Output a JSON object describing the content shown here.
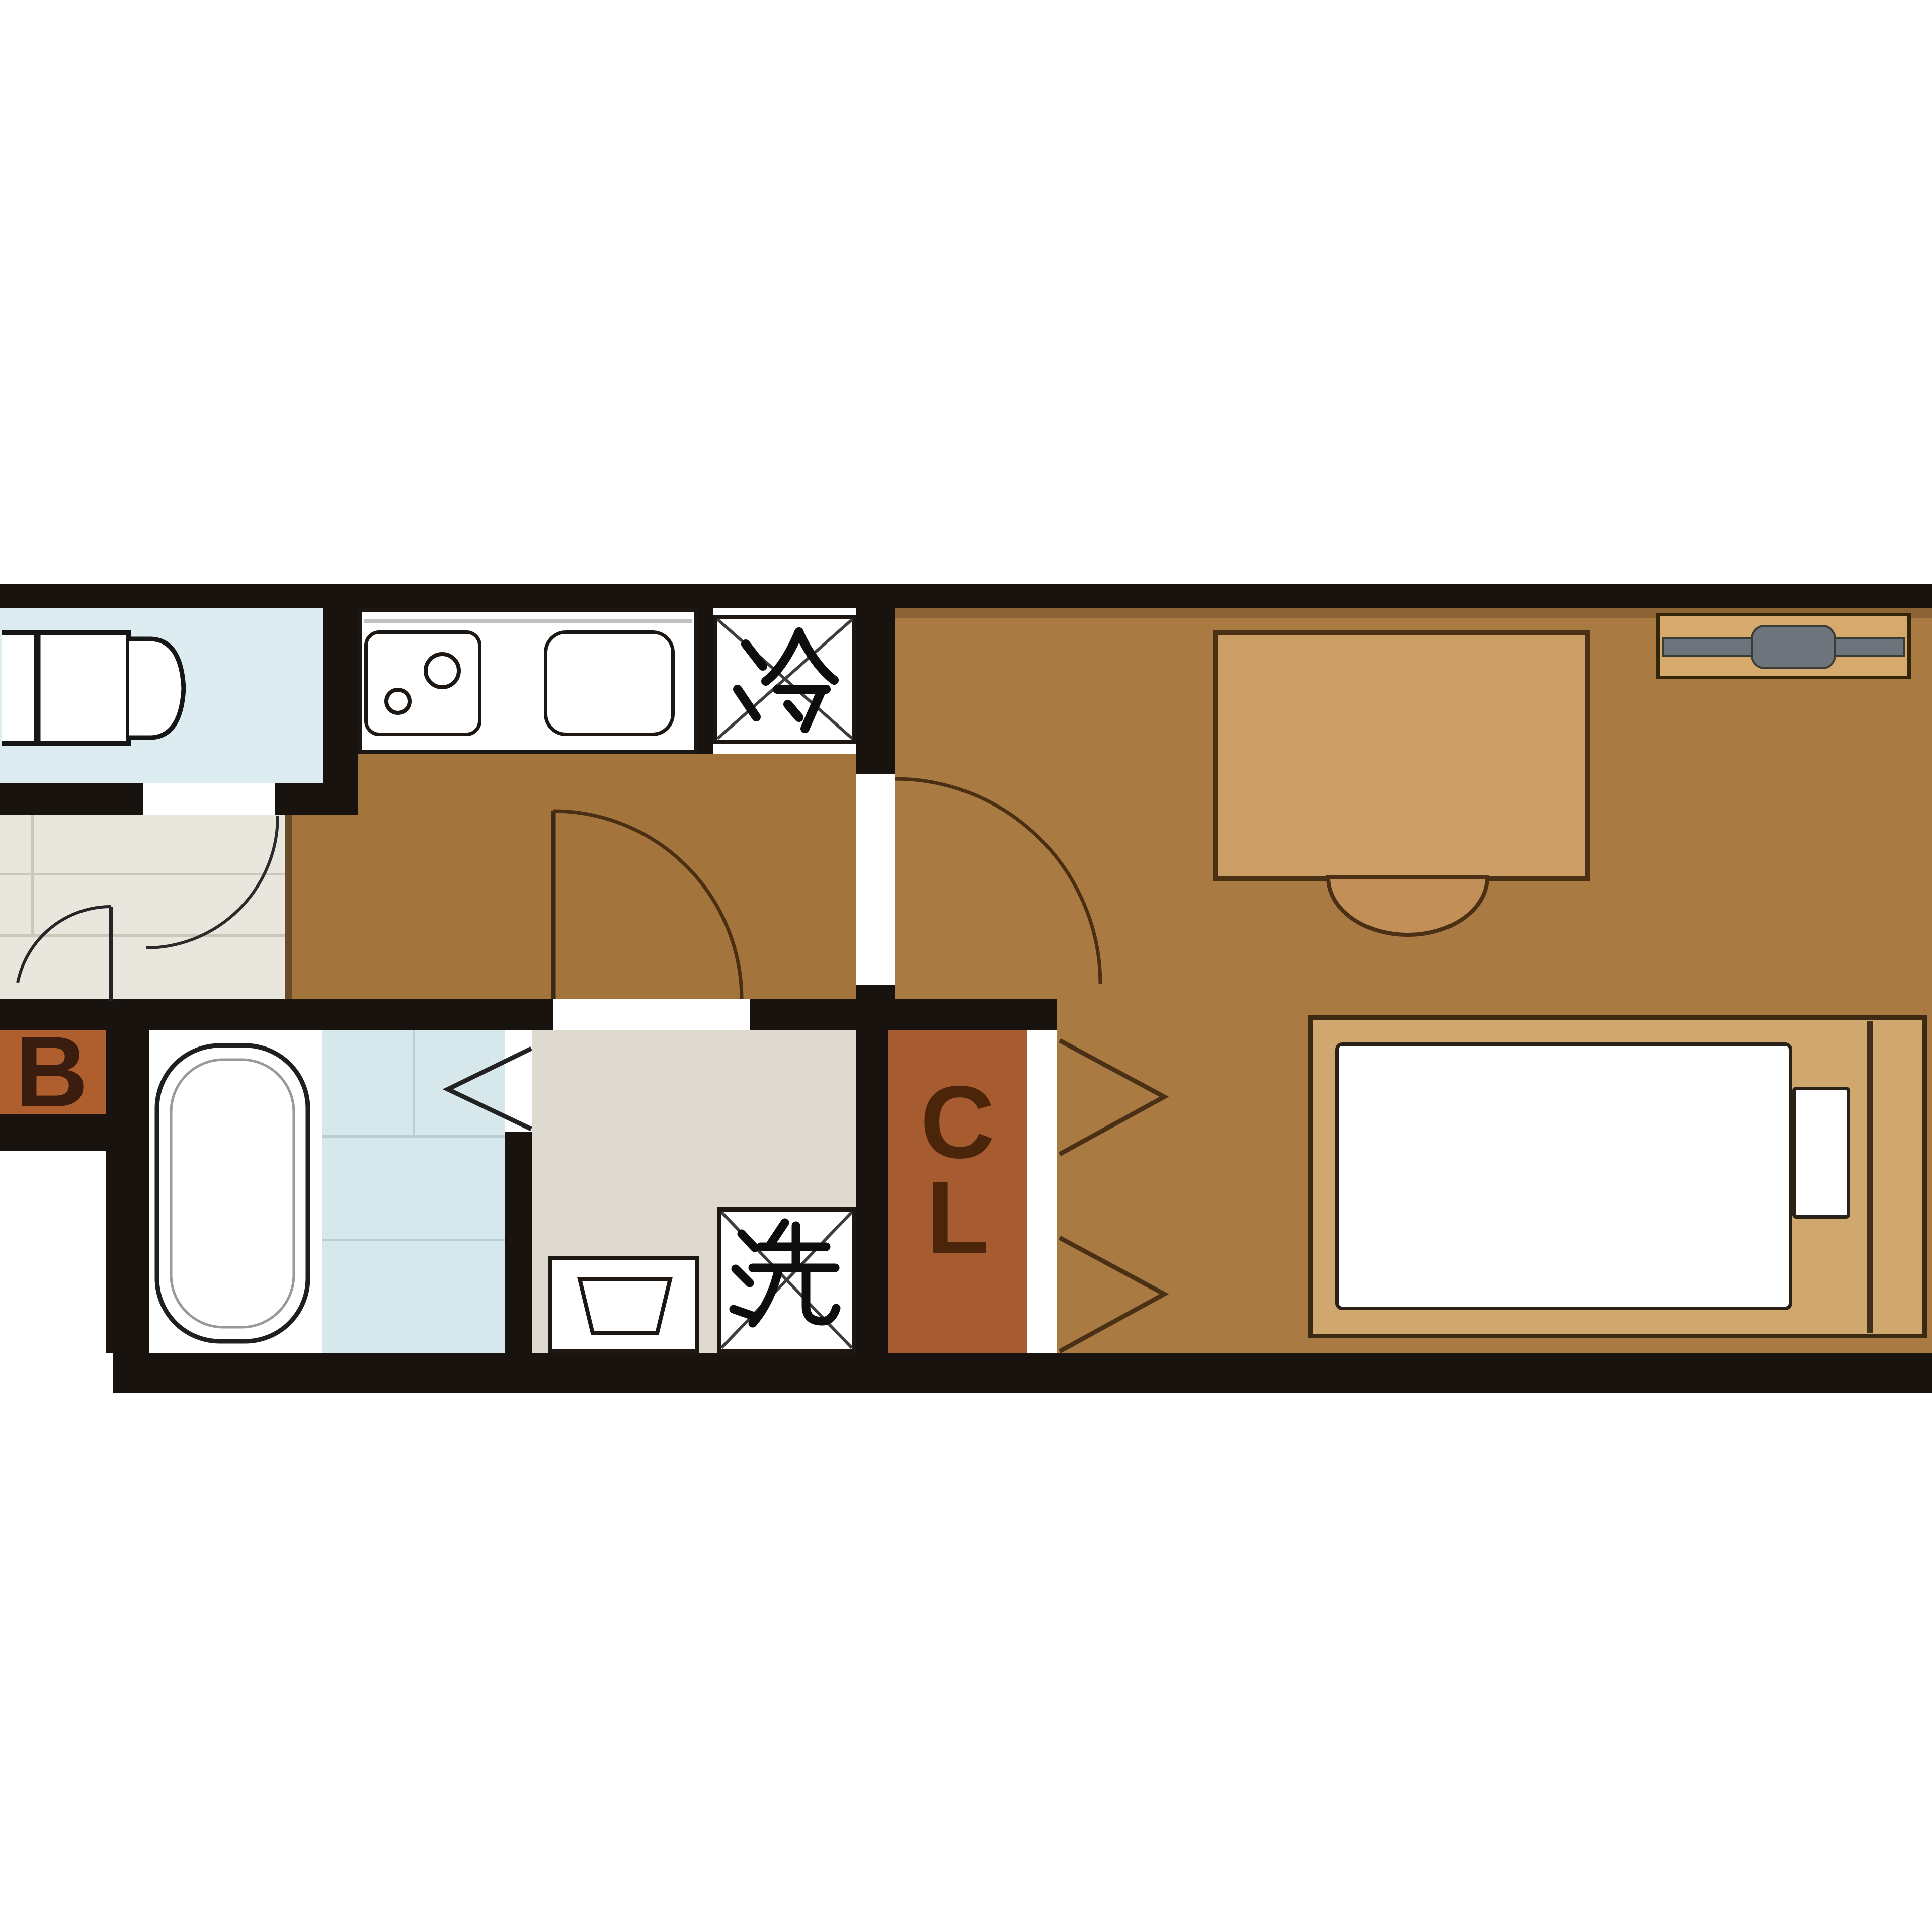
{
  "floor_plan": {
    "labels": {
      "balcony": "B",
      "closet_top": "C",
      "closet_bottom": "L",
      "refrigerator": "冷",
      "washing_machine": "洗"
    },
    "colors": {
      "wall": "#191310",
      "hall_floor": "#a3743c",
      "main_room_floor": "#a97b43",
      "toilet_room_floor": "#dcecf1",
      "bathroom_tile": "#d7e8ed",
      "washroom_floor": "#dedacf",
      "entrance_floor": "#e9e6de",
      "closet_floor": "#a65c30",
      "balcony_floor": "#ae5f2d",
      "desk": "#cb9e66",
      "bed_frame": "#d0a76e",
      "tv": "#6d747b",
      "fixture_white": "#ffffff",
      "label_text": "#3f2410"
    },
    "icons": {
      "refrigerator-box": "crossed box with kanji rei",
      "washing-machine-box": "crossed box with kanji sen",
      "stove-burners": "two circles",
      "sink": "rounded rectangle",
      "bathtub": "rounded tub outline",
      "toilet": "tank and bowl top view",
      "folding-door": "chevron",
      "swing-door": "quarter-circle arc"
    }
  }
}
